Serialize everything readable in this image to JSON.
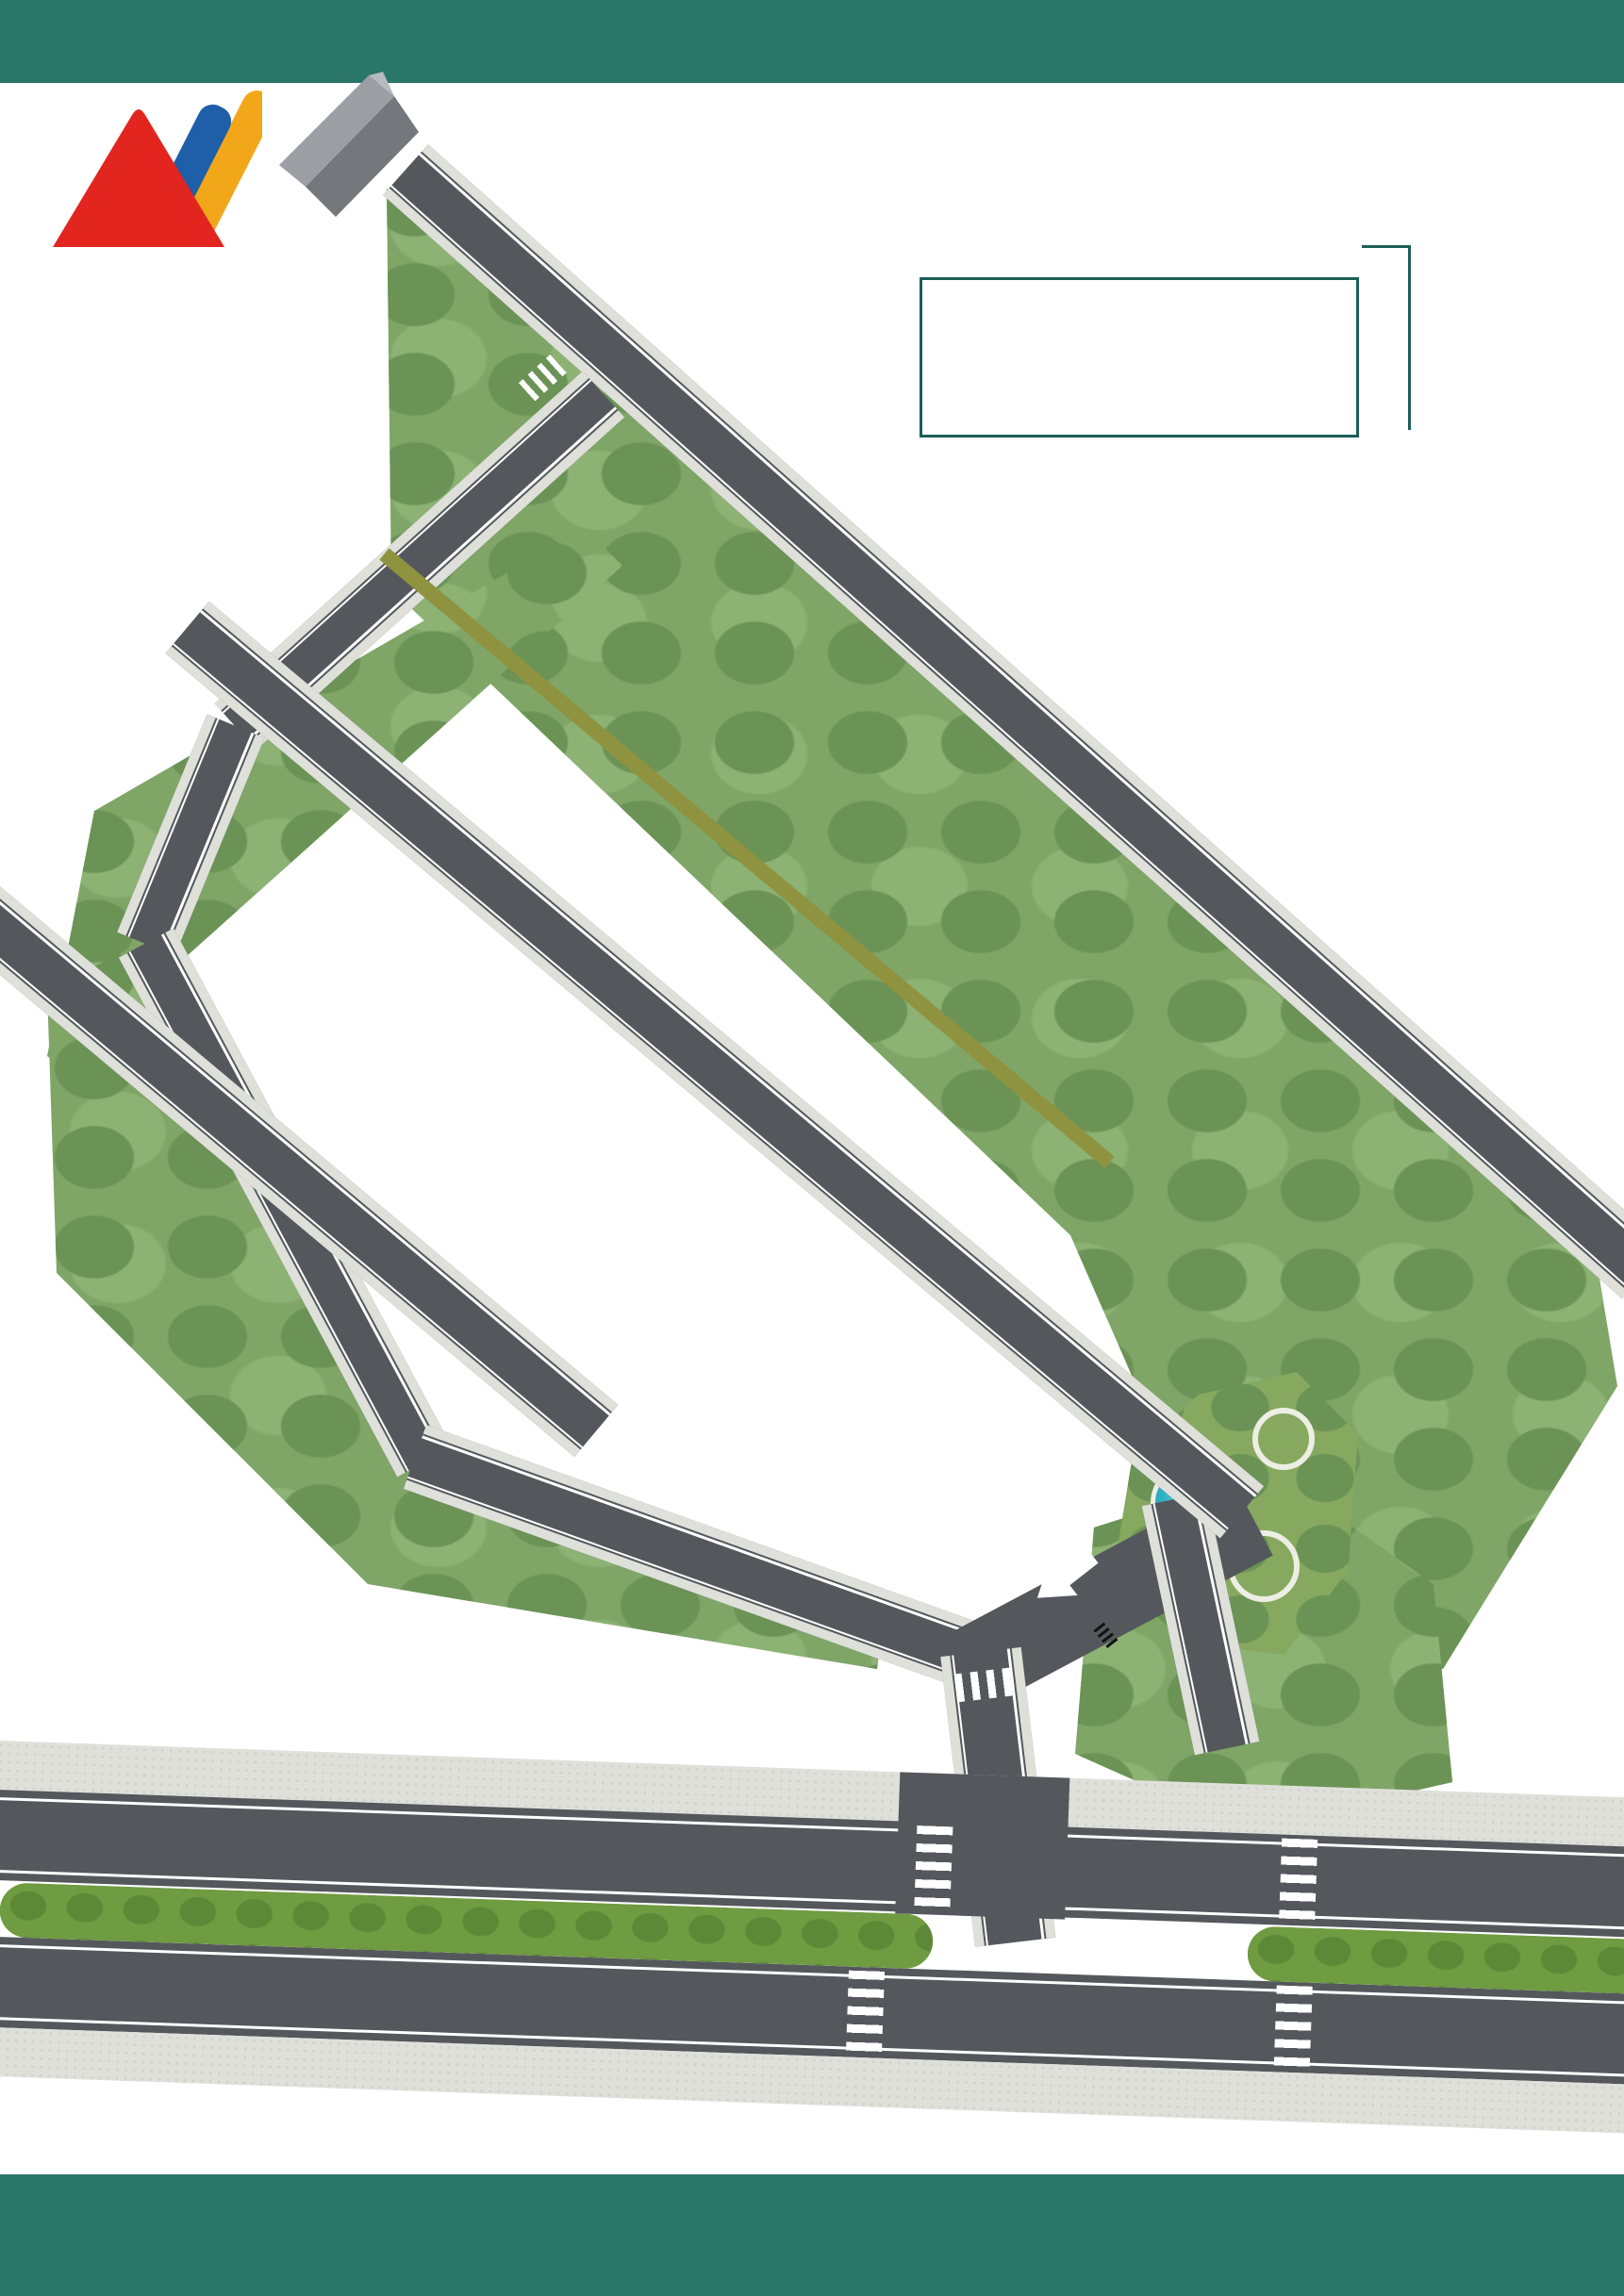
{
  "header": {
    "title": "MẶT BẰNG PHÂN LÔ YÊN BÁI NEW CENTER"
  },
  "logo": {
    "text": "DAI PHAT"
  },
  "legend": {
    "title": "CHÚ THÍCH",
    "items": [
      {
        "label": "LK - A",
        "color": "#4F9BD9"
      },
      {
        "label": "LK - B",
        "color": "#F0835F"
      },
      {
        "label": "LK - C",
        "color": "#F2EE73"
      },
      {
        "label": "LK - D",
        "color": "#77C36B"
      }
    ]
  },
  "compass": {
    "north": "B",
    "east": "E",
    "south": "N",
    "west": "W"
  },
  "roads": {
    "internal_label": "ĐƯỜNG NỘI BỘ",
    "ne_road_label": "ĐƯỜNG ĐI NGUYỄN TẤT THÀNH",
    "boulevard_label": "ĐƯỜNG NGUYỄN TẤT THÀNH",
    "entrance_label": "LỐI VÀO"
  },
  "plot_colors": {
    "A": "#4F9BD9",
    "B": "#F0835F",
    "C": "#F2EE73",
    "D": "#6CBA60",
    "E": "#A9CC50"
  },
  "plots": {
    "row_d": [
      "D22 - 100M²",
      "D21 - 100M²",
      "D20 - 100M²",
      "D19 - 100M²",
      "D18 - 100M²",
      "D17 - 100M²",
      "D16 - 100M²",
      "D15 - 100M²",
      "D14 - 100M²",
      "D13 - 100M²",
      "D12 - 100M²",
      "D11 - 100M²",
      "D10 - 100M²",
      "D9 - 100M²",
      "D8 - 100M²",
      "D7 - 100M²",
      "D6 - 100M²",
      "D5 - 100M²",
      "D4 - 100M²",
      "D3 - 95M²",
      "D2 - 87M²",
      "D1|240M²"
    ],
    "row_c": [
      "C29 - 100M²",
      "C28 - 100M²",
      "C27 - 100M²",
      "C26 - 100M²",
      "C25 - 100M²",
      "C24 - 100M²",
      "C23 - 100M²",
      "C22 - 100M²",
      "C21 - 100M²",
      "C20 - 100M²",
      "C19 - 100M²",
      "C18 - 100M²",
      "C17 - 100M²",
      "C16 - 100M²",
      "C15 - 100M²",
      "C14 - 100M²",
      "C13 - 100M²",
      "C12 - 100M²",
      "C11 - 100M²",
      "C10 - 100M²",
      "C9 - 100M²",
      "C8 - 100M²",
      "C7 - 100M²",
      "C6 - 100M²",
      "C5 - 100M²",
      "C4 - 100M²",
      "C3 - 100M²",
      "C2 - 100M²",
      "C1 - 100M²"
    ],
    "row_b": [
      "B24|135M²",
      "B23 - 95M²",
      "B22 - 100M²",
      "B21 - 100M²",
      "B20 - 100M²",
      "B19 - 100M²",
      "B18 - 100M²",
      "B17 - 100M²",
      "B16 - 100M²",
      "B15 - 100M²",
      "B14 - 100M²",
      "B13 - 100M²",
      "B12 - 100M²",
      "B11 - 100M²",
      "B10 - 100M²",
      "B9 - 100M²",
      "B8 - 100M²",
      "B7 - 100M²",
      "B6 - 100M²",
      "B5 - 100M²",
      "B4 - 100M²",
      "B3 - 100M²"
    ],
    "row_b_wedge": [
      "B1 - 125M",
      "B2 - 115M"
    ],
    "row_a": [
      "A6 - 220M²",
      "A5 - 100M²",
      "A4 - 100M²",
      "A3 - 100M²",
      "A2 - 100M²",
      "A1 - 86M²"
    ],
    "row_e": [
      "E1 - 100M²",
      "E2 - 96M²"
    ]
  }
}
